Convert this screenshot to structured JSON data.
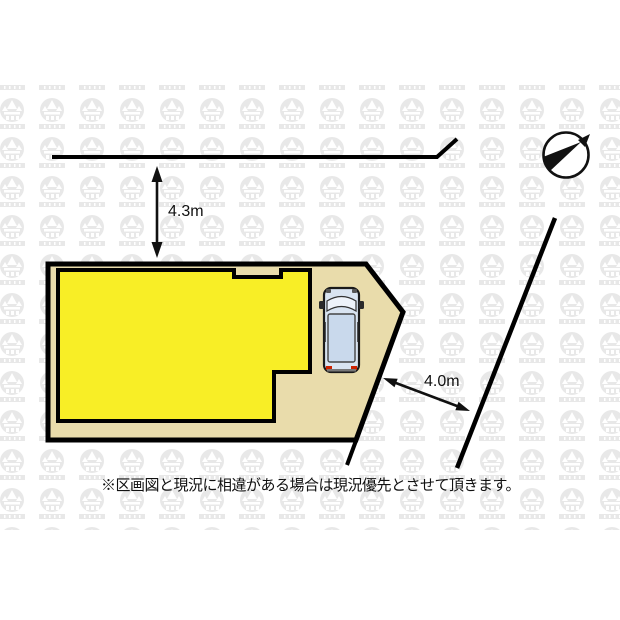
{
  "site_plan": {
    "note": "※区画図と現況に相違がある場合は現況優先とさせて頂きます。",
    "dimensions": [
      {
        "label": "4.3m",
        "meaning": "frontage distance from north road to lot"
      },
      {
        "label": "4.0m",
        "meaning": "width between lot edge and east road"
      }
    ],
    "colors": {
      "lot_fill": "#e9dcab",
      "building_fill": "#f8ee26",
      "outline": "#000000",
      "car_body": "#d9e4f1",
      "car_cabin": "#c9d9ec",
      "car_glass": "#eef3fa",
      "taillight": "#cc2200",
      "watermark": "#e8e8e8"
    },
    "icons": {
      "compass": "compass-needle-icon",
      "vehicle": "car-top-view-icon",
      "watermark": "logo-badge-watermark"
    }
  }
}
